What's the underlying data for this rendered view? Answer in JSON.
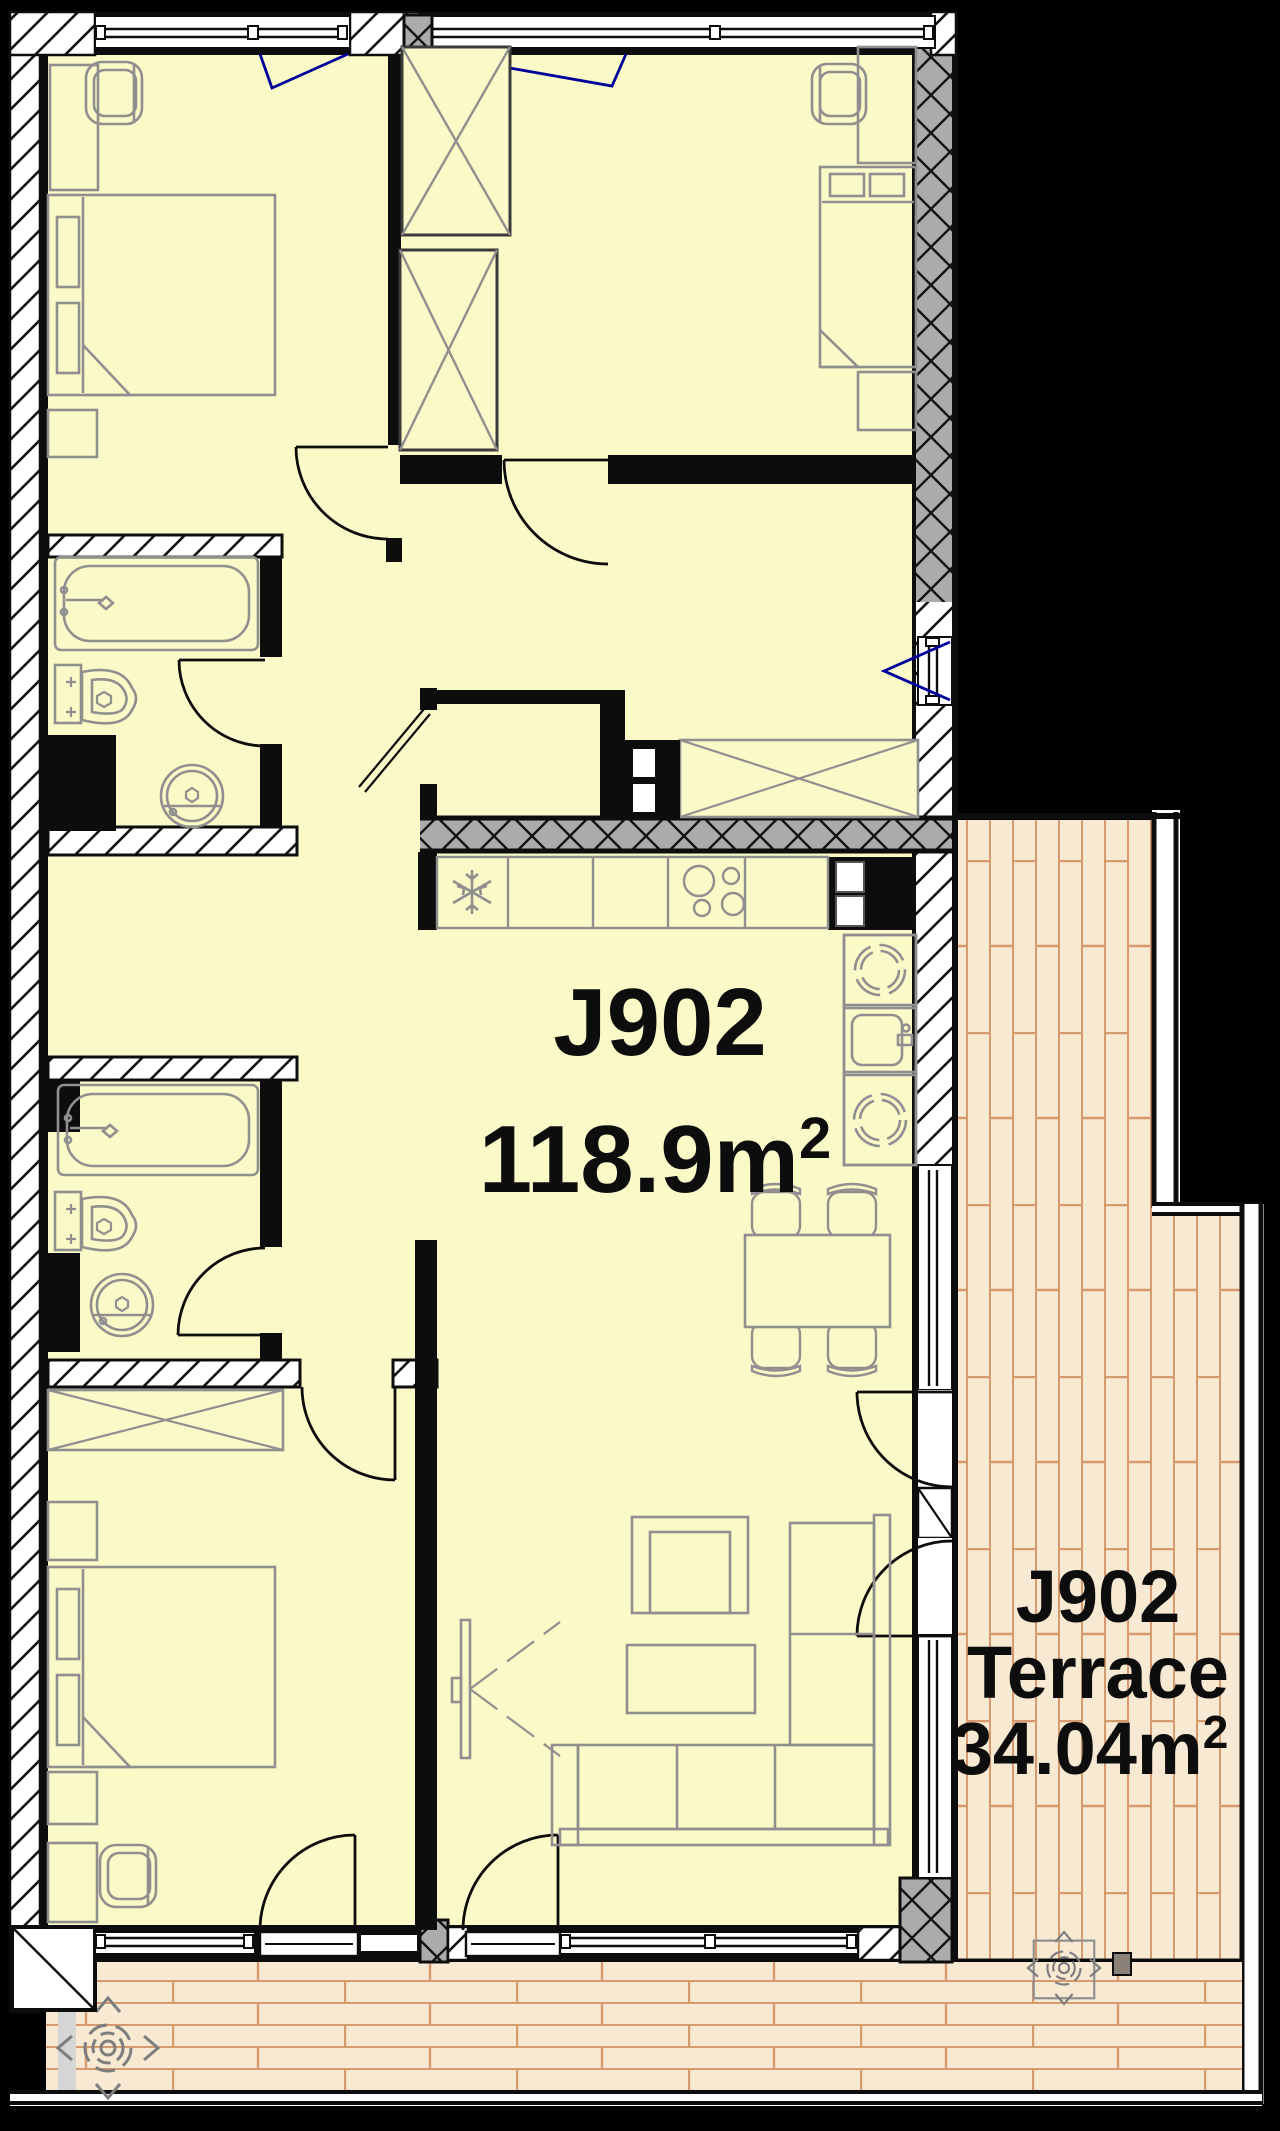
{
  "labels": {
    "unit": {
      "id": "J902",
      "area": "118.9m",
      "area_sup": "2"
    },
    "terrace": {
      "id": "J902",
      "name": "Terrace",
      "area": "34.04m",
      "area_sup": "2"
    }
  },
  "colors": {
    "background": "#000000",
    "floor": "#FAFAC8",
    "wall": "#0d0d0d",
    "structure_gray": "#ABABAB",
    "terrace_deck": "#F7E9D2",
    "deck_line": "#D79A6E",
    "furniture_line": "#8F8F8F",
    "window_swing_blue": "#00009B",
    "label_text": "#0d0d0d"
  },
  "fixtures": [
    "bed-icon",
    "nightstand-icon",
    "armchair-icon",
    "side-table-icon",
    "desk-icon",
    "desk-chair-icon",
    "wardrobe-icon",
    "bathtub-icon",
    "toilet-icon",
    "washbasin-icon",
    "washing-machine-icon",
    "sink-icon",
    "fridge-snowflake-icon",
    "hob-icon",
    "kitchen-counter-icon",
    "dining-table-icon",
    "dining-chair-icon",
    "sofa-icon",
    "coffee-table-icon",
    "tv-icon",
    "door-swing-arc",
    "window-swing-arc",
    "sprinkler-symbol"
  ]
}
